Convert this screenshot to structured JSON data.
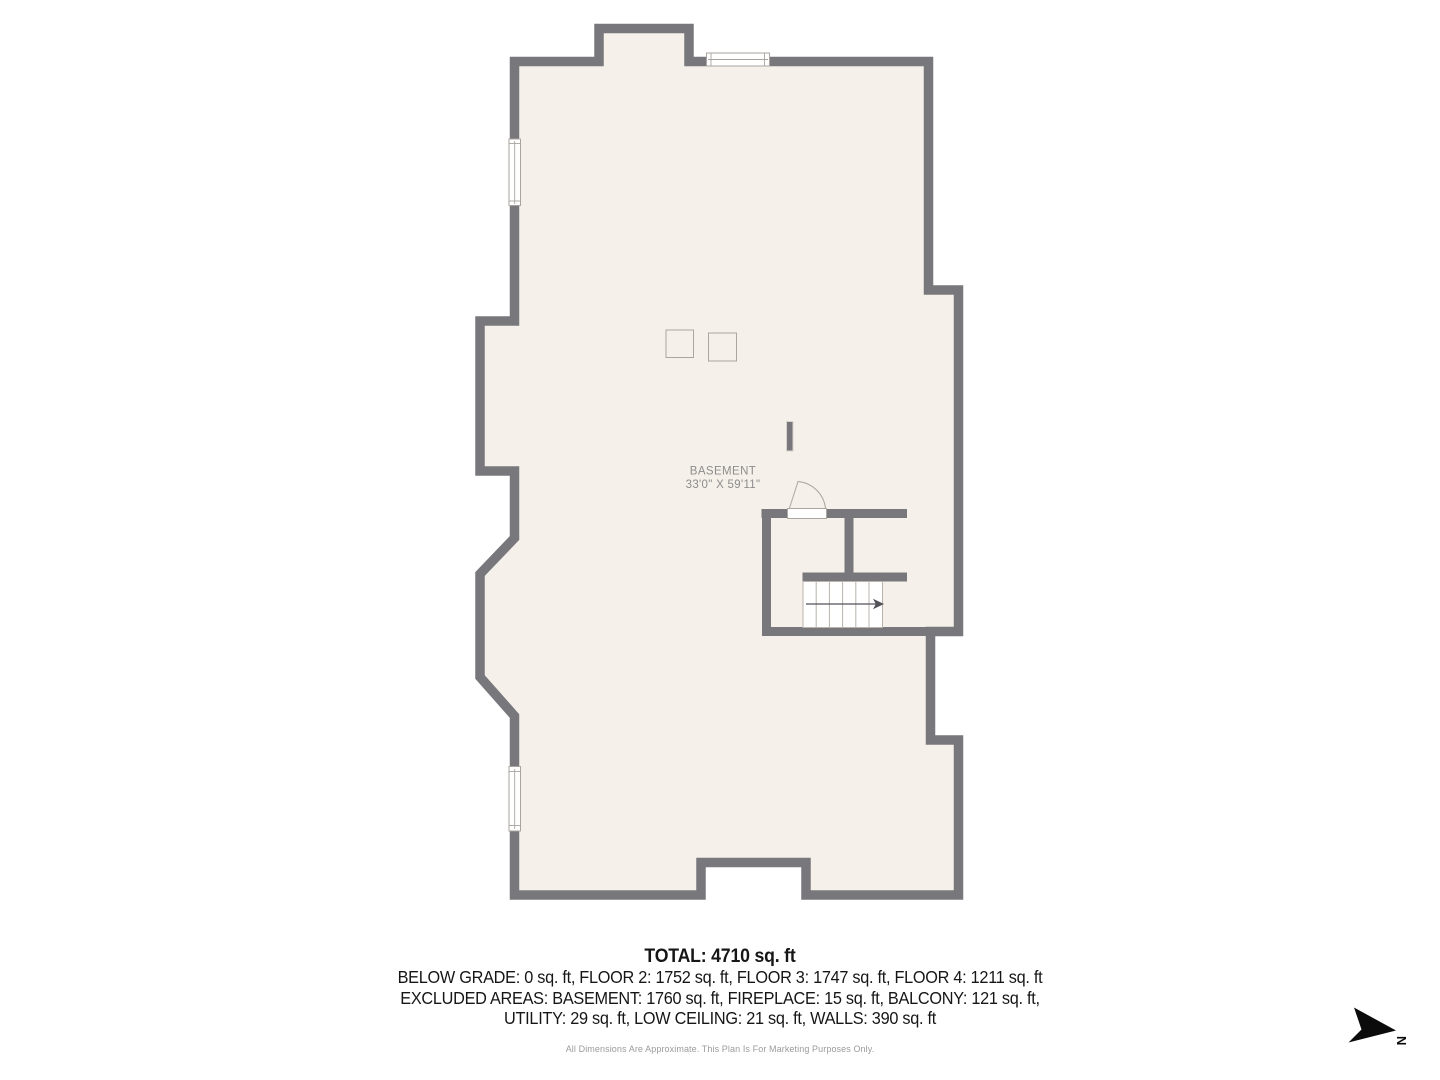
{
  "plan": {
    "room_label": "BASEMENT",
    "room_dimensions": "33'0\" X 59'11\"",
    "colors": {
      "wall": "#78777b",
      "floor": "#f6f0ea",
      "thin_line": "#aba69f",
      "label_text": "#8c8c8c",
      "stair_fill": "#ffffff",
      "arrow": "#535257",
      "compass": "#0b0b0b"
    }
  },
  "summary": {
    "total": "TOTAL: 4710 sq. ft",
    "breakdown_line_1": "BELOW GRADE: 0 sq. ft, FLOOR 2: 1752 sq. ft, FLOOR 3: 1747 sq. ft, FLOOR 4: 1211 sq. ft",
    "breakdown_line_2": "EXCLUDED AREAS: BASEMENT: 1760 sq. ft, FIREPLACE: 15 sq. ft, BALCONY: 121 sq. ft,",
    "breakdown_line_3": "UTILITY: 29 sq. ft, LOW CEILING: 21 sq. ft, WALLS: 390 sq. ft",
    "disclaimer": "All Dimensions Are Approximate. This Plan Is For Marketing Purposes Only."
  },
  "compass": {
    "label": "N"
  }
}
